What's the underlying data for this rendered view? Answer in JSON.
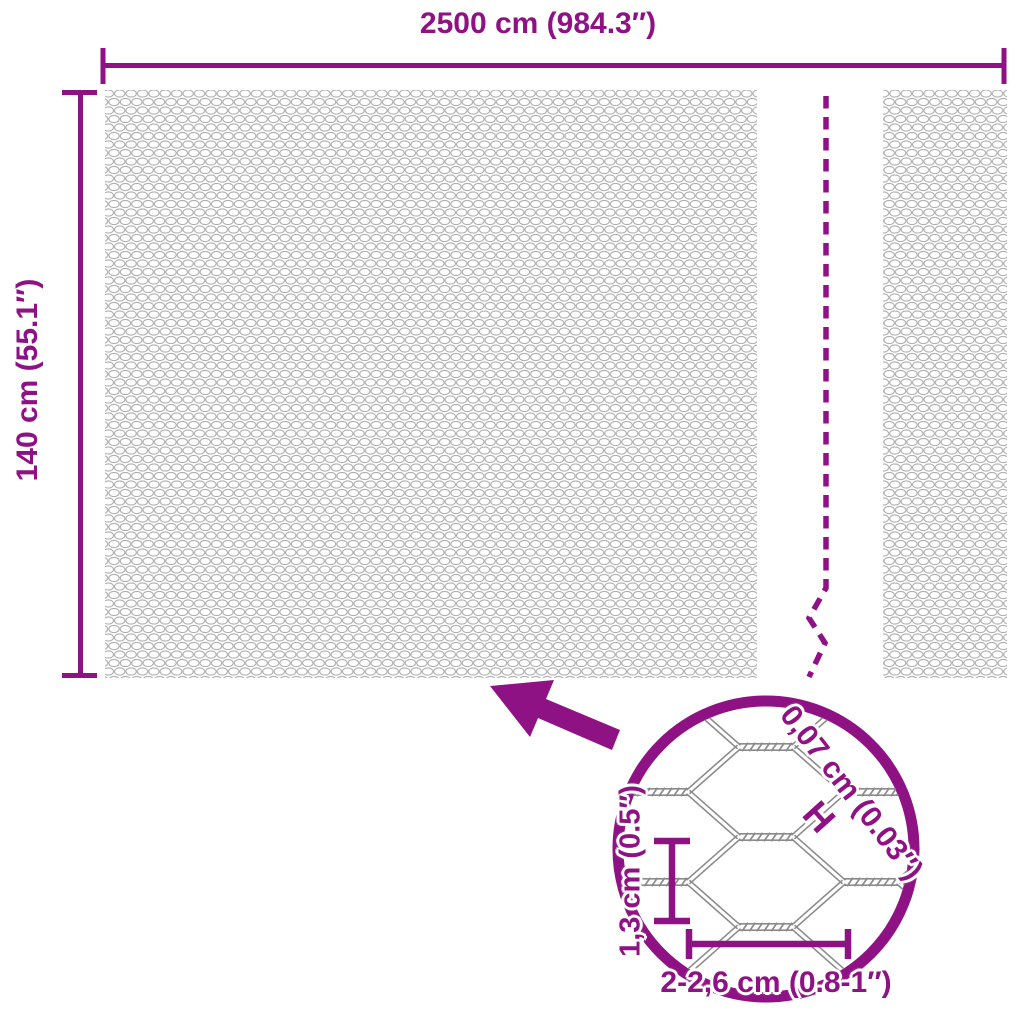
{
  "colors": {
    "accent": "#8f1284",
    "wire": "#8b8b8b",
    "mesh": "#aeaeae"
  },
  "diagram": {
    "width_label": "2500 cm (984.3″)",
    "height_label": "140 cm (55.1″)",
    "detail": {
      "wire_thickness_label": "0,07 cm (0.03″)",
      "wire_thickness_symbol": "H",
      "cell_height_label": "1,3 cm (0.5″)",
      "cell_width_label": "2-2,6 cm (0.8-1″)"
    }
  }
}
